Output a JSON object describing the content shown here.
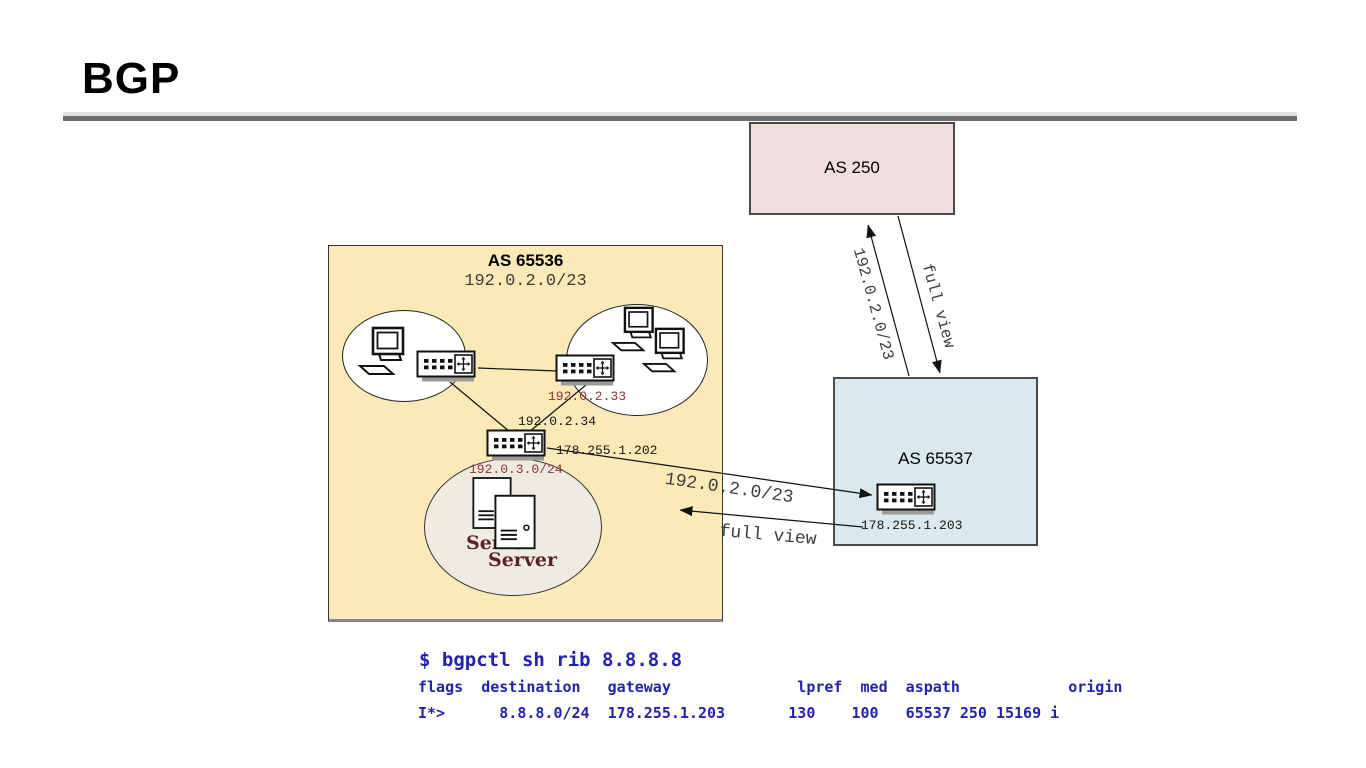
{
  "title": "BGP",
  "as250": {
    "label": "AS 250"
  },
  "as65536": {
    "label": "AS 65536",
    "prefix": "192.0.2.0/23"
  },
  "as65537": {
    "label": "AS 65537"
  },
  "ips": {
    "router1": "192.0.2.33",
    "router2": "192.0.2.34",
    "router2_wan": "178.255.1.202",
    "server_subnet": "192.0.3.0/24",
    "router3": "178.255.1.203"
  },
  "servers": {
    "back": "Server",
    "front": "Server"
  },
  "arrows": {
    "announce_up": "192.0.2.0/23",
    "fullview_down": "full view",
    "announce_right": "192.0.2.0/23",
    "fullview_left": "full view"
  },
  "terminal": {
    "command": "$ bgpctl sh rib 8.8.8.8",
    "header": "flags  destination   gateway              lpref  med  aspath            origin",
    "row": "I*>      8.8.8.0/24  178.255.1.203       130    100   65537 250 15169 i"
  },
  "colors": {
    "as250_fill": "#f1dede",
    "as65536_fill": "#fbe9b8",
    "as65537_fill": "#d9e9ee",
    "server_ellipse_fill": "#efebe0",
    "terminal_text": "#2222ac",
    "maroon_label": "#8b3535",
    "server_caption": "#5c2222"
  }
}
